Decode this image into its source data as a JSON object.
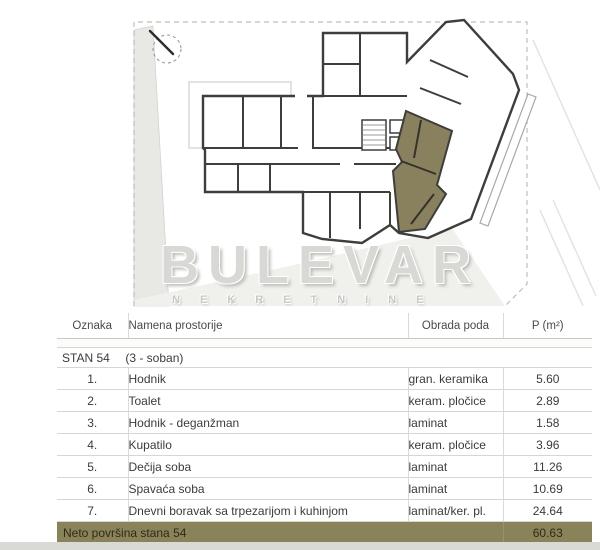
{
  "plan": {
    "watermark_title": "BULEVAR",
    "watermark_subtitle": "NEKRETNINE",
    "highlight_color": "#89805e",
    "wall_color": "#3d3d3b"
  },
  "table": {
    "headers": {
      "oznaka": "Oznaka",
      "namena": "Namena prostorije",
      "obrada": "Obrada poda",
      "p": "P (m²)"
    },
    "section": {
      "label": "STAN 54",
      "sublabel": "(3 - soban)"
    },
    "rows": [
      {
        "oznaka": "1.",
        "namena": "Hodnik",
        "obrada": "gran. keramika",
        "p": "5.60"
      },
      {
        "oznaka": "2.",
        "namena": "Toalet",
        "obrada": "keram. pločice",
        "p": "2.89"
      },
      {
        "oznaka": "3.",
        "namena": "Hodnik - deganžman",
        "obrada": "laminat",
        "p": "1.58"
      },
      {
        "oznaka": "4.",
        "namena": "Kupatilo",
        "obrada": "keram. pločice",
        "p": "3.96"
      },
      {
        "oznaka": "5.",
        "namena": "Dečija soba",
        "obrada": "laminat",
        "p": "11.26"
      },
      {
        "oznaka": "6.",
        "namena": "Spavaća soba",
        "obrada": "laminat",
        "p": "10.69"
      },
      {
        "oznaka": "7.",
        "namena": "Dnevni boravak sa trpezarijom i kuhinjom",
        "obrada": "laminat/ker. pl.",
        "p": "24.64"
      }
    ],
    "footer": {
      "label": "Neto površina stana 54",
      "value": "60.63",
      "bar_color": "#8a8259"
    }
  }
}
